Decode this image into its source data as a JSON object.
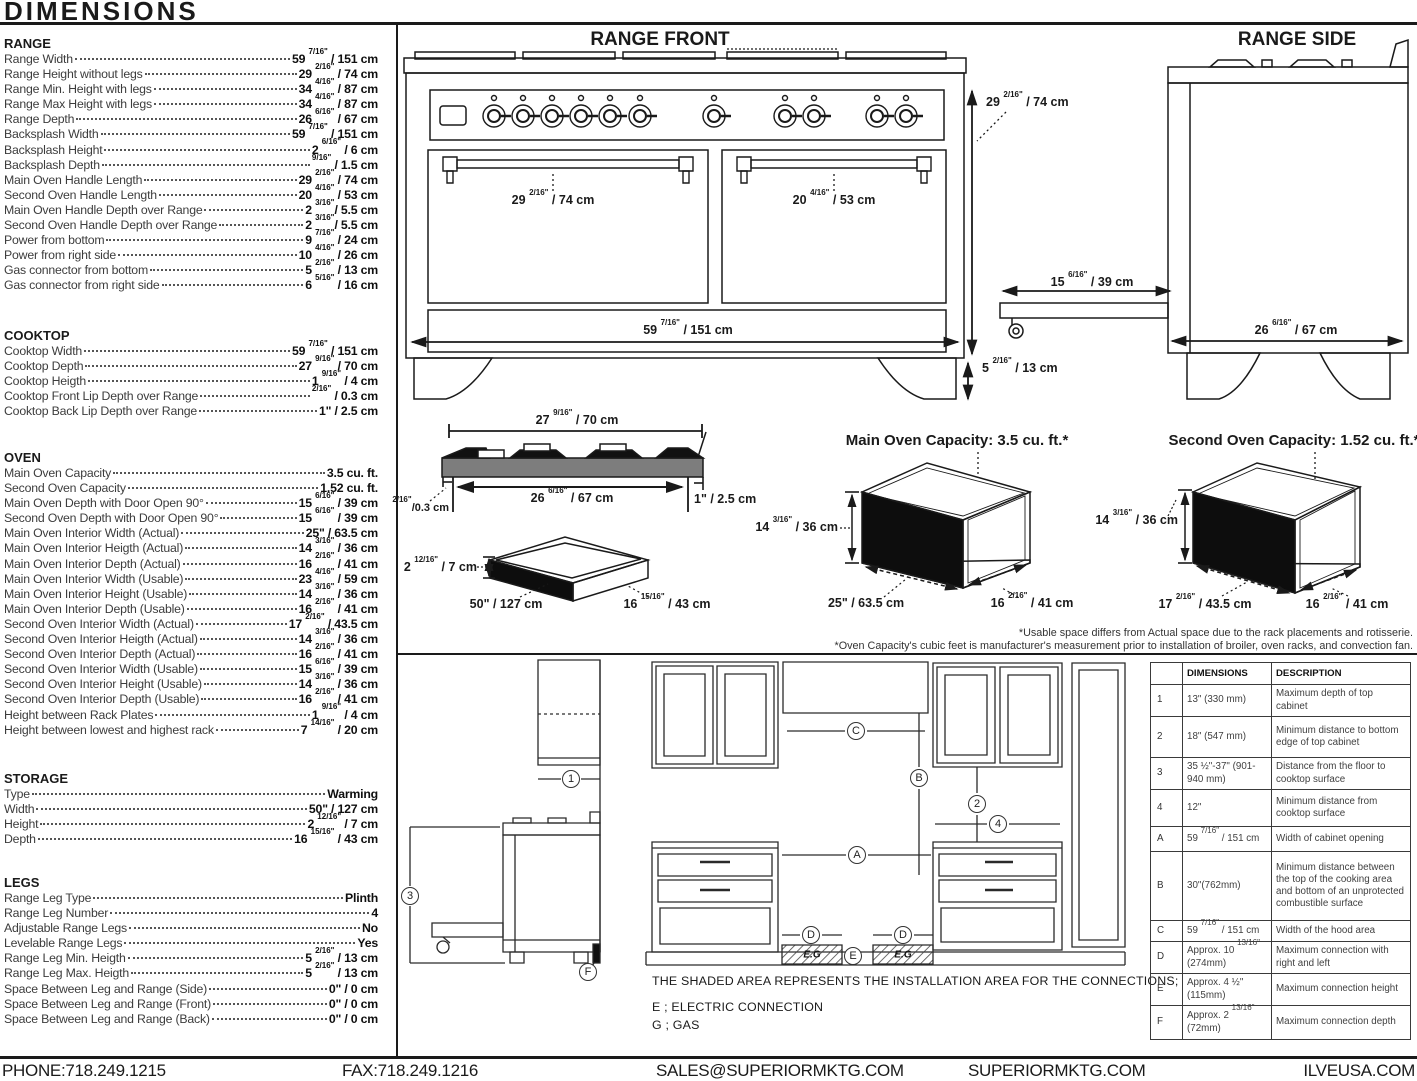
{
  "title": "DIMENSIONS",
  "specs": {
    "sections": [
      {
        "name": "RANGE",
        "rows": [
          {
            "label": "Range Width",
            "value": "59 7/16\" / 151 cm"
          },
          {
            "label": "Range Height without legs",
            "value": "29 2/16\" / 74 cm"
          },
          {
            "label": "Range Min. Height with legs",
            "value": "34 4/16\" / 87 cm"
          },
          {
            "label": "Range Max Height with legs",
            "value": "34 4/16\" / 87 cm"
          },
          {
            "label": "Range Depth",
            "value": "26 6/16\" / 67 cm"
          },
          {
            "label": "Backsplash Width",
            "value": "59 7/16\" / 151 cm"
          },
          {
            "label": "Backsplash Height",
            "value": "2 6/16\" / 6 cm"
          },
          {
            "label": "Backsplash Depth",
            "value": "9/16\" / 1.5 cm"
          },
          {
            "label": "Main Oven Handle Length",
            "value": "29 2/16\" / 74 cm"
          },
          {
            "label": "Second Oven Handle Length",
            "value": "20 4/16\" / 53 cm"
          },
          {
            "label": "Main Oven Handle Depth over Range",
            "value": "2 3/16\"/ 5.5 cm"
          },
          {
            "label": "Second Oven Handle Depth over Range",
            "value": "2 3/16\"/ 5.5 cm"
          },
          {
            "label": "Power from bottom",
            "value": "9 7/16\" / 24 cm"
          },
          {
            "label": "Power from right side",
            "value": "10 4/16\" / 26 cm"
          },
          {
            "label": "Gas connector from bottom",
            "value": "5 2/16\" / 13 cm"
          },
          {
            "label": "Gas connector from right side",
            "value": "6 5/16\" / 16 cm"
          }
        ]
      },
      {
        "name": "COOKTOP",
        "rows": [
          {
            "label": "Cooktop Width",
            "value": "59 7/16\" / 151 cm"
          },
          {
            "label": "Cooktop Depth",
            "value": "27 9/16\" / 70 cm"
          },
          {
            "label": "Cooktop Heigth",
            "value": "1 9/16\" / 4 cm"
          },
          {
            "label": "Cooktop Front Lip Depth over Range",
            "value": "2/16\" / 0.3 cm"
          },
          {
            "label": "Cooktop Back Lip Depth over Range",
            "value": "1\" / 2.5 cm"
          }
        ]
      },
      {
        "name": "OVEN",
        "rows": [
          {
            "label": "Main Oven Capacity",
            "value": "3.5 cu. ft."
          },
          {
            "label": "Second Oven Capacity",
            "value": "1.52 cu. ft."
          },
          {
            "label": "Main Oven Depth with Door Open 90°",
            "value": "15 6/16\" / 39 cm"
          },
          {
            "label": "Second Oven Depth with Door Open 90°",
            "value": "15 6/16\" / 39 cm"
          },
          {
            "label": "Main Oven Interior Width (Actual)",
            "value": "25\" / 63.5 cm"
          },
          {
            "label": "Main Oven Interior Heigth (Actual)",
            "value": "14 3/16\" / 36 cm"
          },
          {
            "label": "Main Oven Interior Depth (Actual)",
            "value": "16 2/16\" / 41 cm"
          },
          {
            "label": "Main Oven Interior Width (Usable)",
            "value": "23 4/16\" / 59 cm"
          },
          {
            "label": "Main Oven Interior Height (Usable)",
            "value": "14 3/16\" / 36 cm"
          },
          {
            "label": "Main Oven Interior Depth (Usable)",
            "value": "16 2/16\" / 41 cm"
          },
          {
            "label": "Second Oven Interior Width (Actual)",
            "value": "17 2/16\" / 43.5 cm"
          },
          {
            "label": "Second Oven Interior Heigth (Actual)",
            "value": "14 3/16\" / 36 cm"
          },
          {
            "label": "Second Oven Interior Depth (Actual)",
            "value": "16 2/16\" / 41 cm"
          },
          {
            "label": "Second Oven Interior Width (Usable)",
            "value": "15 6/16\" / 39 cm"
          },
          {
            "label": "Second Oven Interior Height (Usable)",
            "value": "14 3/16\" / 36 cm"
          },
          {
            "label": "Second Oven Interior Depth (Usable)",
            "value": "16 2/16\" / 41 cm"
          },
          {
            "label": "Height between Rack Plates",
            "value": "1 9/16\" / 4 cm"
          },
          {
            "label": "Height between lowest and highest rack",
            "value": "7 14/16\" / 20 cm"
          }
        ]
      },
      {
        "name": "STORAGE",
        "rows": [
          {
            "label": "Type",
            "value": "Warming"
          },
          {
            "label": "Width",
            "value": "50\" / 127 cm"
          },
          {
            "label": "Height",
            "value": "2 12/16\" / 7 cm"
          },
          {
            "label": "Depth",
            "value": "16 15/16\" / 43 cm"
          }
        ]
      },
      {
        "name": "LEGS",
        "rows": [
          {
            "label": "Range Leg Type",
            "value": "Plinth"
          },
          {
            "label": "Range Leg Number",
            "value": "4"
          },
          {
            "label": "Adjustable Range Legs",
            "value": "No"
          },
          {
            "label": "Levelable Range Legs",
            "value": "Yes"
          },
          {
            "label": "Range Leg Min. Heigth",
            "value": "5 2/16\" / 13 cm"
          },
          {
            "label": "Range Leg Max. Heigth",
            "value": "5 2/16\" / 13 cm"
          },
          {
            "label": "Space Between Leg and Range (Side)",
            "value": "0\" / 0 cm"
          },
          {
            "label": "Space Between Leg and Range (Front)",
            "value": "0\" / 0 cm"
          },
          {
            "label": "Space Between Leg and Range (Back)",
            "value": "0\" / 0 cm"
          }
        ]
      }
    ]
  },
  "front": {
    "title": "RANGE FRONT",
    "dim_main_handle": "29 2/16\" / 74 cm",
    "dim_second_handle": "20 4/16\" / 53 cm",
    "dim_width": "59 7/16\" / 151 cm",
    "dim_height": "29 2/16\" / 74 cm",
    "dim_leg": "5 2/16\" / 13 cm"
  },
  "side": {
    "title": "RANGE SIDE",
    "dim_drawer": "15 6/16\" / 39 cm",
    "dim_depth": "26 6/16\" / 67 cm"
  },
  "cooktop_drawing": {
    "dim_top": "27 9/16\" / 70 cm",
    "dim_inner": "26 6/16\" / 67 cm",
    "dim_back_lip": "1\" / 2.5 cm",
    "dim_front_lip": "2/16\"/0.3 cm"
  },
  "storage_drawing": {
    "dim_height": "2 12/16\" / 7 cm",
    "dim_width": "50\" / 127 cm",
    "dim_depth": "16 15/16\" / 43 cm"
  },
  "main_oven": {
    "title": "Main Oven Capacity: 3.5 cu. ft.*",
    "dim_height": "14 3/16\" / 36 cm",
    "dim_width": "25\" / 63.5 cm",
    "dim_depth": "16 2/16\" / 41 cm"
  },
  "second_oven": {
    "title": "Second Oven Capacity: 1.52 cu. ft.*",
    "dim_height": "14 3/16\" / 36 cm",
    "dim_width": "17 2/16\" / 43.5 cm",
    "dim_depth": "16 2/16\" / 41 cm"
  },
  "notes": {
    "line1": "*Usable space differs from Actual space due to the rack placements and rotisserie.",
    "line2": "*Oven Capacity's cubic feet is manufacturer's measurement prior to installation of broiler, oven racks, and convection fan."
  },
  "installation": {
    "shaded_note": "THE SHADED AREA REPRESENTS THE INSTALLATION AREA FOR THE CONNECTIONS;",
    "electric": "E ; ELECTRIC CONNECTION",
    "gas": "G ; GAS",
    "eg": "E.G"
  },
  "markers": {
    "n1": "1",
    "n2": "2",
    "n3": "3",
    "n4": "4",
    "a": "A",
    "b": "B",
    "c": "C",
    "d": "D",
    "e": "E",
    "f": "F"
  },
  "table": {
    "headers": [
      "",
      "DIMENSIONS",
      "DESCRIPTION"
    ],
    "rows": [
      {
        "id": "1",
        "dims": "13\" (330 mm)",
        "desc": "Maximum depth of top cabinet"
      },
      {
        "id": "2",
        "dims": "18\" (547 mm)",
        "desc": "Minimum distance to bottom edge of top cabinet"
      },
      {
        "id": "3",
        "dims": "35 ½\"-37\" (901-940 mm)",
        "desc": "Distance from the floor to cooktop surface"
      },
      {
        "id": "4",
        "dims": "12\"",
        "desc": "Minimum distance from cooktop surface"
      },
      {
        "id": "A",
        "dims": "59 7/16\" / 151 cm",
        "desc": "Width of cabinet opening"
      },
      {
        "id": "B",
        "dims": "30\"(762mm)",
        "desc": "Minimum distance between the top of the cooking area and bottom of an unprotected combustible surface"
      },
      {
        "id": "C",
        "dims": "59 7/16\" / 151 cm",
        "desc": "Width of the hood area"
      },
      {
        "id": "D",
        "dims": "Approx. 10 13/16\" (274mm)",
        "desc": "Maximum connection with right and left"
      },
      {
        "id": "E",
        "dims": "Approx. 4 ½\" (115mm)",
        "desc": "Maximum connection height"
      },
      {
        "id": "F",
        "dims": "Approx. 2 13/16\" (72mm)",
        "desc": "Maximum connection depth"
      }
    ]
  },
  "footer": {
    "phone": "PHONE:718.249.1215",
    "fax": "FAX:718.249.1216",
    "email": "SALES@SUPERIORMKTG.COM",
    "website": "SUPERIORMKTG.COM",
    "brand": "ILVEUSA.COM"
  }
}
